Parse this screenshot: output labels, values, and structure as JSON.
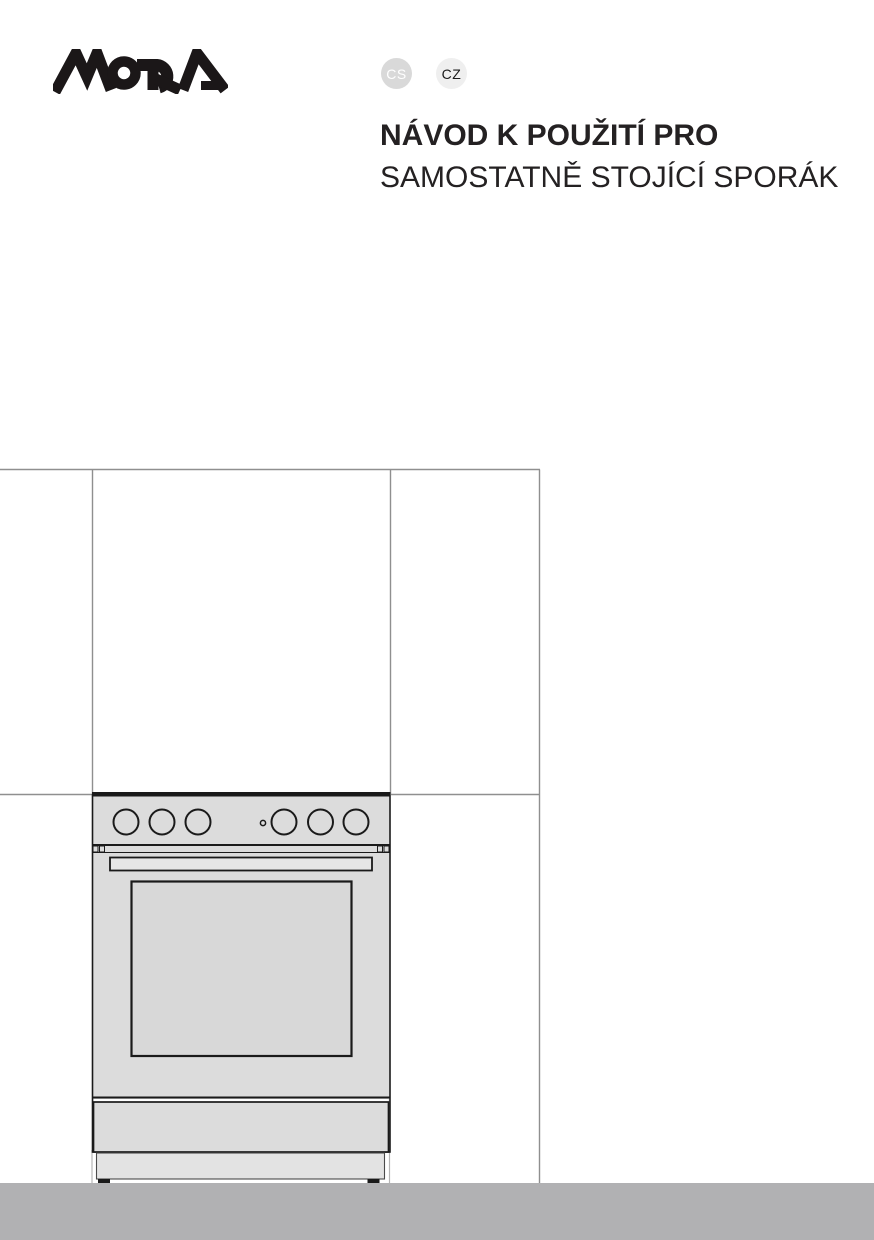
{
  "header": {
    "brand": "MORA",
    "badges": [
      {
        "code": "CS"
      },
      {
        "code": "CZ"
      }
    ],
    "title_line1": "NÁVOD K POUŽITÍ PRO",
    "title_line2": "SAMOSTATNĚ STOJÍCÍ SPORÁK"
  },
  "illustration": {
    "label": "freestanding-cooker-front-view-line-drawing",
    "knob_count": 6
  },
  "colors": {
    "page_bg": "#ffffff",
    "text": "#242122",
    "logo": "#1b1718",
    "badge_cs_bg": "#d9d9d9",
    "badge_cs_text": "#ffffff",
    "badge_cz_bg": "#efefef",
    "badge_cz_text": "#1a1a1a",
    "wall_line": "#8f8f8f",
    "outline": "#1a1a1a",
    "body_gray": "#dcdcdc",
    "window_gray": "#d8d8d8",
    "handle_gray": "#e6e6e6",
    "plinth_gray": "#e3e3e3",
    "floor_gray": "#b1b1b3"
  }
}
